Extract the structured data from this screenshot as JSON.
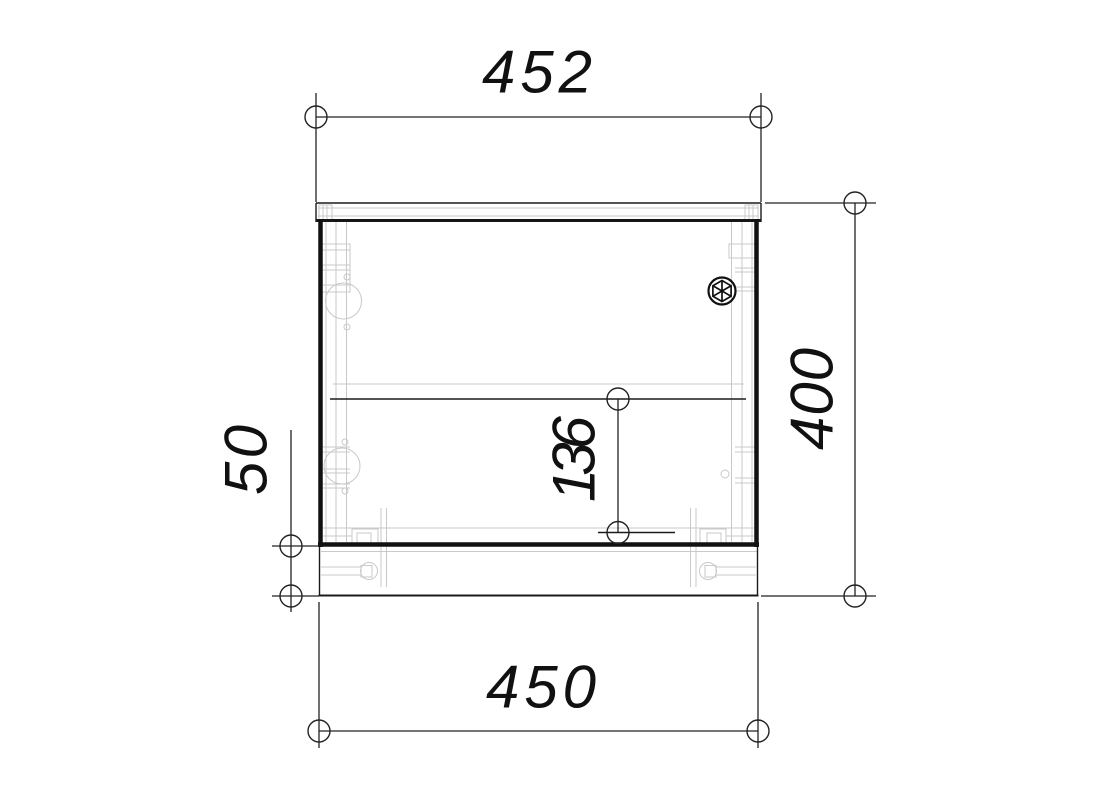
{
  "drawing": {
    "title": "cabinet-section-technical-drawing",
    "dimensions": {
      "top_width": {
        "label": "452"
      },
      "bottom_width": {
        "label": "450"
      },
      "overall_height": {
        "label": "400"
      },
      "inner_height": {
        "label": "136"
      },
      "plinth_height": {
        "label": "50"
      }
    },
    "colors": {
      "outline_dark": "#1a1a1a",
      "detail_light": "#c9c9c9",
      "dimension_line": "#222222",
      "background": "#ffffff"
    }
  }
}
